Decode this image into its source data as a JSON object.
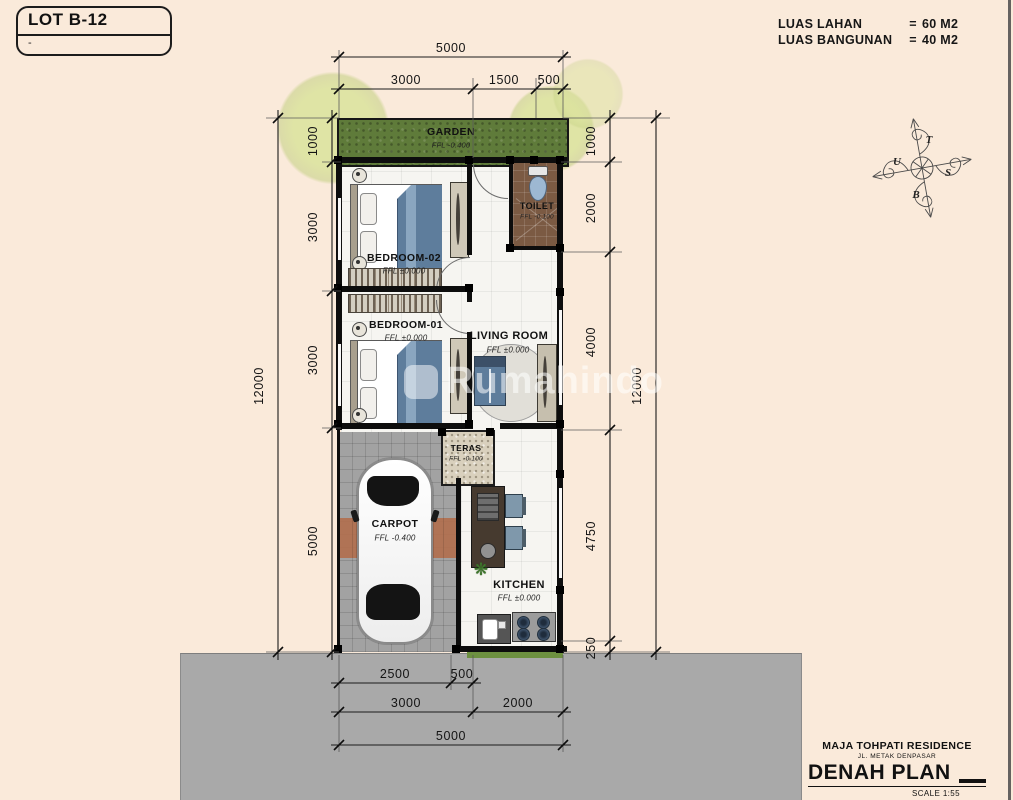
{
  "lot": {
    "label": "LOT B-12",
    "sub": "-"
  },
  "site_info": {
    "rows": [
      {
        "label": "LUAS LAHAN",
        "eq": "=",
        "value": "60  M2"
      },
      {
        "label": "LUAS BANGUNAN",
        "eq": "=",
        "value": "40  M2"
      }
    ]
  },
  "compass": {
    "top": "T",
    "right": "S",
    "bottom": "B",
    "left": "U"
  },
  "rooms": {
    "garden": {
      "name": "GARDEN",
      "ffl": "FFL -0.400"
    },
    "bedroom2": {
      "name": "BEDROOM-02",
      "ffl": "FFL ±0.000"
    },
    "toilet": {
      "name": "TOILET",
      "ffl": "FFL -0.100"
    },
    "bedroom1": {
      "name": "BEDROOM-01",
      "ffl": "FFL ±0.000"
    },
    "living": {
      "name": "LIVING ROOM",
      "ffl": "FFL ±0.000"
    },
    "teras": {
      "name": "TERAS",
      "ffl": "FFL -0.100"
    },
    "carpot": {
      "name": "CARPOT",
      "ffl": "FFL -0.400"
    },
    "kitchen": {
      "name": "KITCHEN",
      "ffl": "FFL ±0.000"
    }
  },
  "dims": {
    "top_total": "5000",
    "top": [
      "3000",
      "1500",
      "500"
    ],
    "left": [
      "1000",
      "3000",
      "3000",
      "5000"
    ],
    "left_total": "12000",
    "right": [
      "1000",
      "2000",
      "4000",
      "4750",
      "250"
    ],
    "right_total": "12000",
    "bottom_a": [
      "2500",
      "500"
    ],
    "bottom_b": [
      "3000",
      "2000"
    ],
    "bottom_total": "5000"
  },
  "watermark": {
    "text": "Rumahindo"
  },
  "title_block": {
    "project": "MAJA TOHPATI RESIDENCE",
    "address": "JL. METAK DENPASAR",
    "drawing": "DENAH PLAN",
    "scale": "SCALE 1:55"
  },
  "colors": {
    "background": "#faeada",
    "road": "#a9a9a9",
    "garden_green": "#5f7b3a",
    "toilet_brown": "#7b5a43",
    "blanket_blue": "#5e7d9c",
    "paver_band": "#b1704e"
  }
}
